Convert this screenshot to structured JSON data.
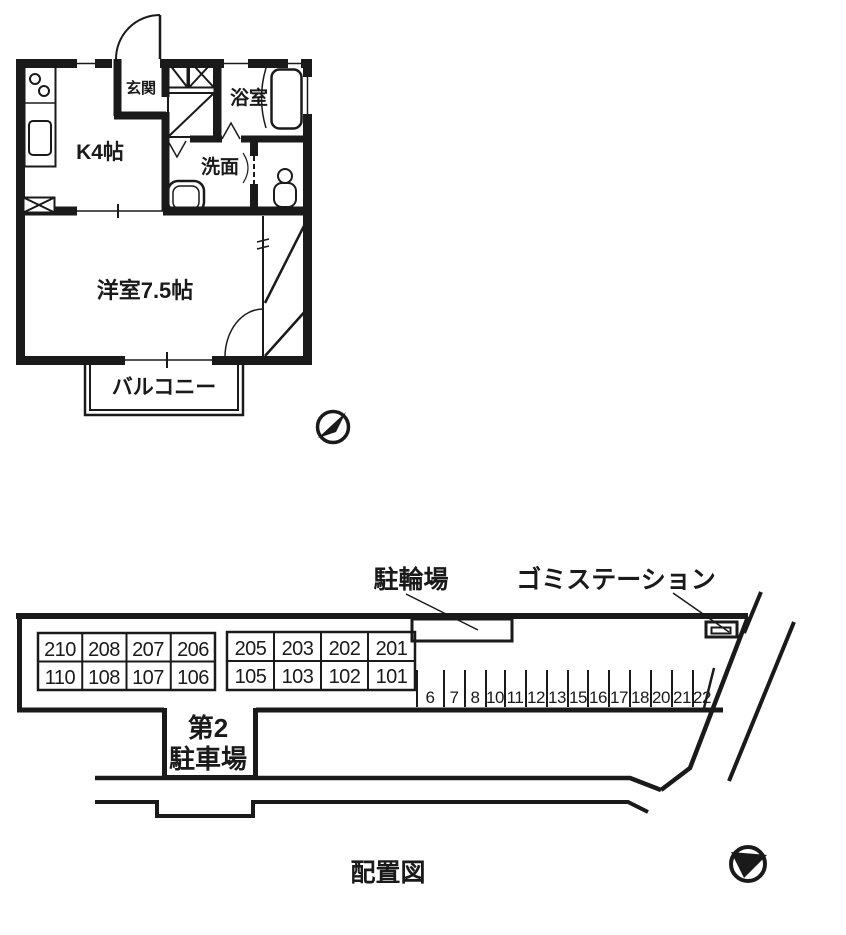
{
  "colors": {
    "ink": "#1a1a1a",
    "paper": "#ffffff"
  },
  "floorplan": {
    "entrance_label": "玄関",
    "kitchen_label": "K4帖",
    "bath_label": "浴室",
    "washroom_label": "洗面",
    "room_label": "洋室7.5帖",
    "balcony_label": "バルコニー"
  },
  "siteplan": {
    "bicycle_label": "駐輪場",
    "garbage_label": "ゴミステーション",
    "parking2_line1": "第2",
    "parking2_line2": "駐車場",
    "caption": "配置図",
    "table1": {
      "rows": [
        [
          "210",
          "208",
          "207",
          "206"
        ],
        [
          "110",
          "108",
          "107",
          "106"
        ]
      ]
    },
    "table2": {
      "rows": [
        [
          "205",
          "203",
          "202",
          "201"
        ],
        [
          "105",
          "103",
          "102",
          "101"
        ]
      ]
    },
    "stalls": [
      "6",
      "7",
      "8",
      "10",
      "11",
      "12",
      "13",
      "15",
      "16",
      "17",
      "18",
      "20",
      "21",
      "22"
    ]
  }
}
